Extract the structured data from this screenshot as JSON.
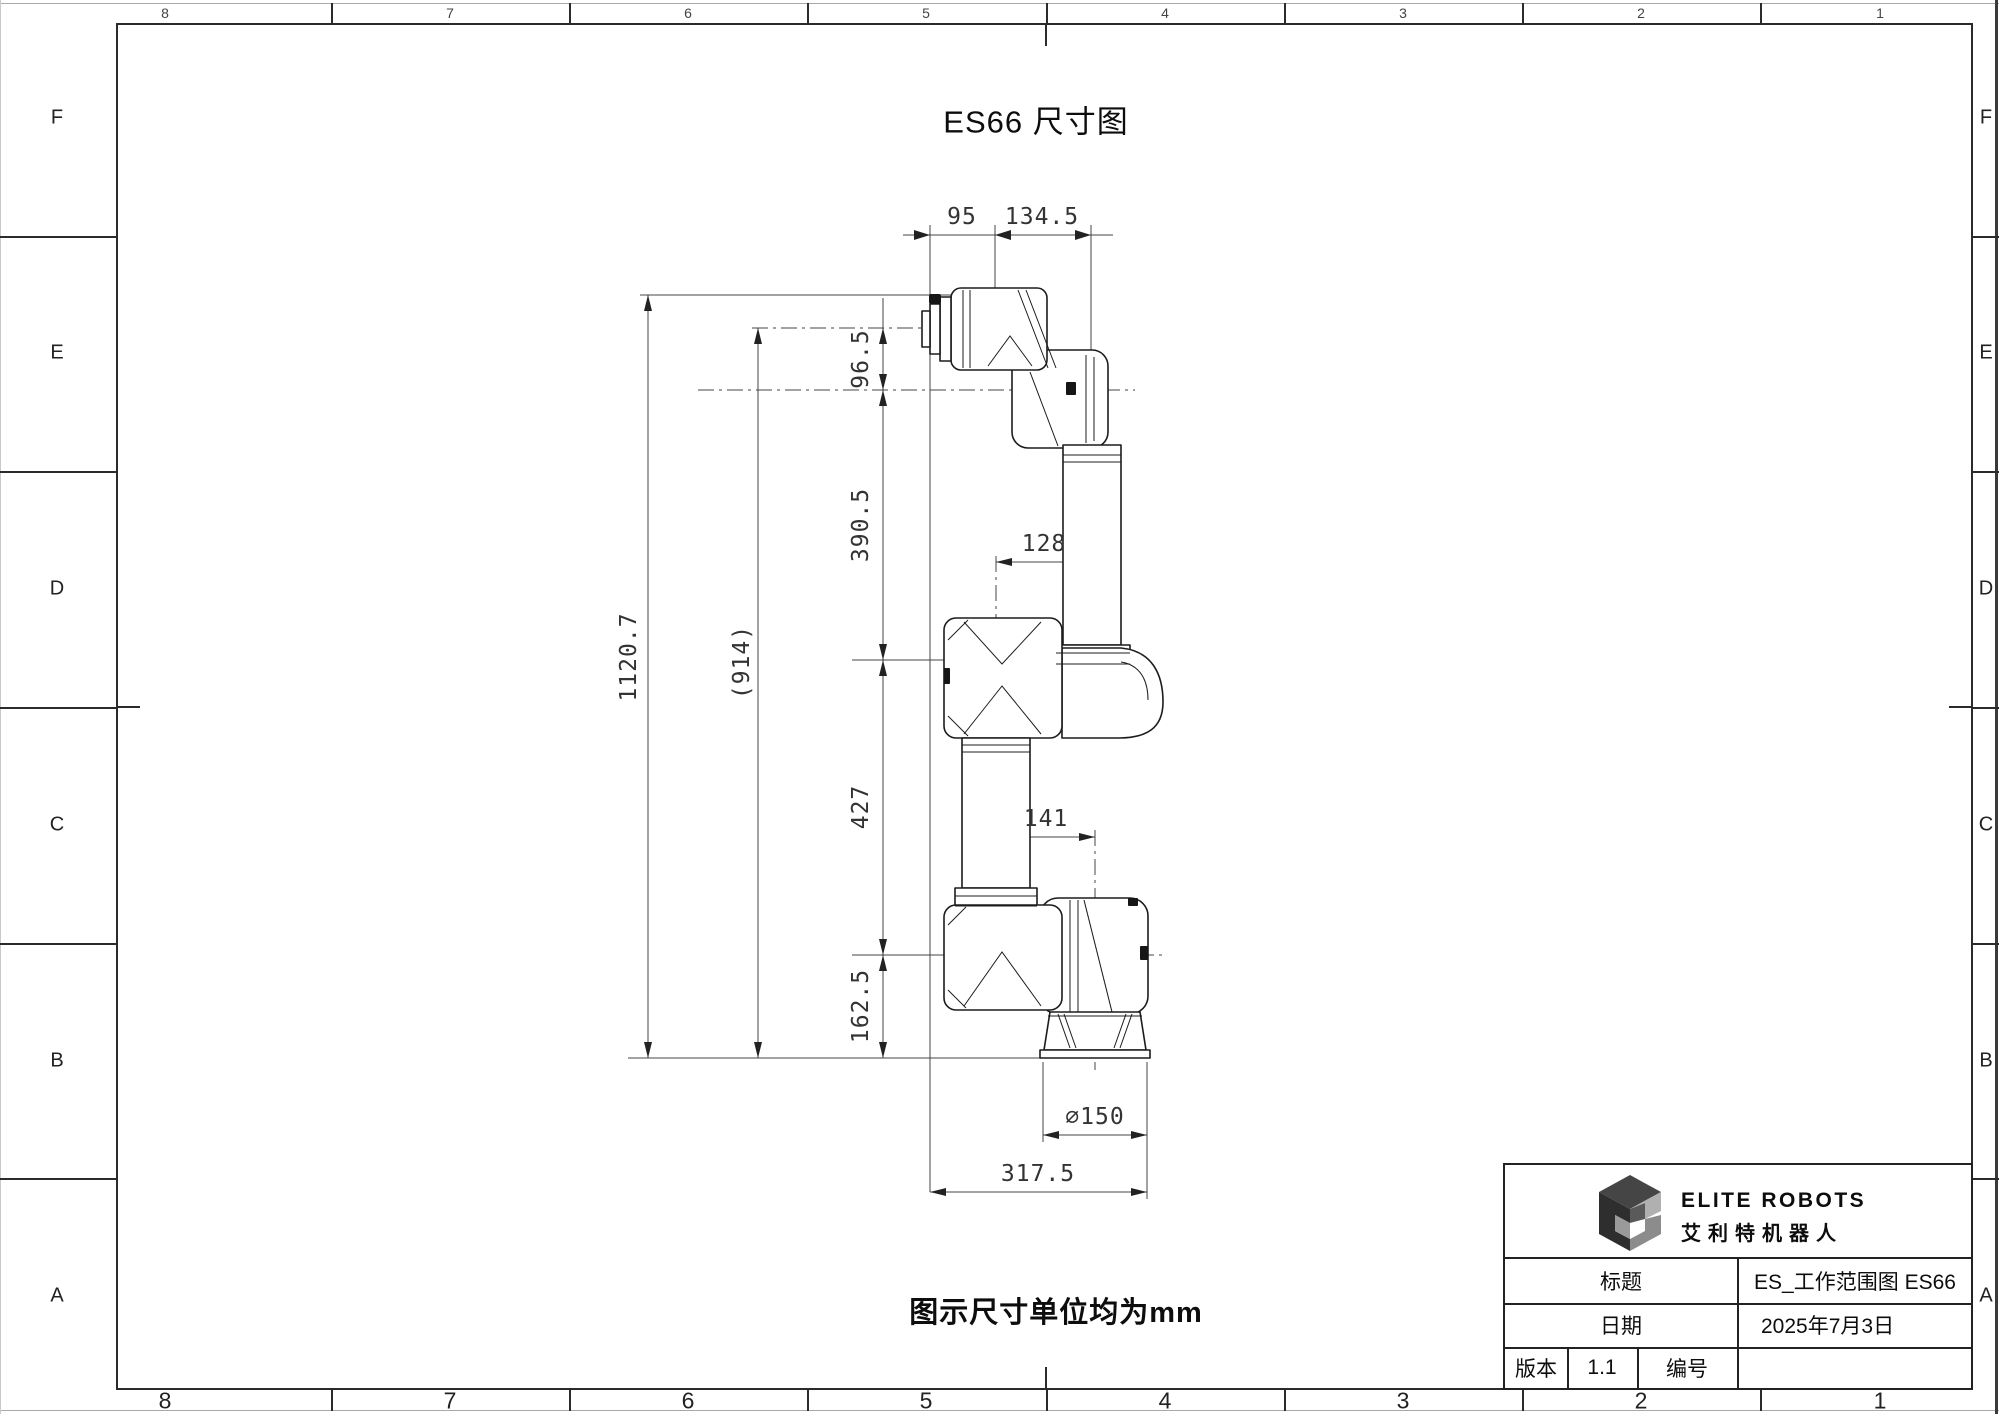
{
  "sheet": {
    "title": "ES66 尺寸图",
    "note": "图示尺寸单位均为mm"
  },
  "zones": {
    "columns": [
      "8",
      "7",
      "6",
      "5",
      "4",
      "3",
      "2",
      "1"
    ],
    "rows": [
      "F",
      "E",
      "D",
      "C",
      "B",
      "A"
    ]
  },
  "dims": {
    "d95": "95",
    "d134_5": "134.5",
    "d96_5": "96.5",
    "d390_5": "390.5",
    "d1120_7": "1120.7",
    "d914": "(914)",
    "d128": "128",
    "d427": "427",
    "d141": "141",
    "d162_5": "162.5",
    "d150": "∅150",
    "d317_5": "317.5"
  },
  "title_block": {
    "brand_en": "ELITE ROBOTS",
    "brand_cn": "艾利特机器人",
    "title_label": "标题",
    "title_value": "ES_工作范围图 ES66",
    "date_label": "日期",
    "date_value": "2025年7月3日",
    "version_label": "版本",
    "version_value": "1.1",
    "number_label": "编号",
    "number_value": ""
  },
  "colors": {
    "line": "#1c1c1c",
    "dim": "#444444",
    "frame": "#2b2b2b",
    "logo_dark": "#2e2e2e",
    "logo_mid": "#4a4a4a",
    "logo_light": "#b0b0b0"
  }
}
